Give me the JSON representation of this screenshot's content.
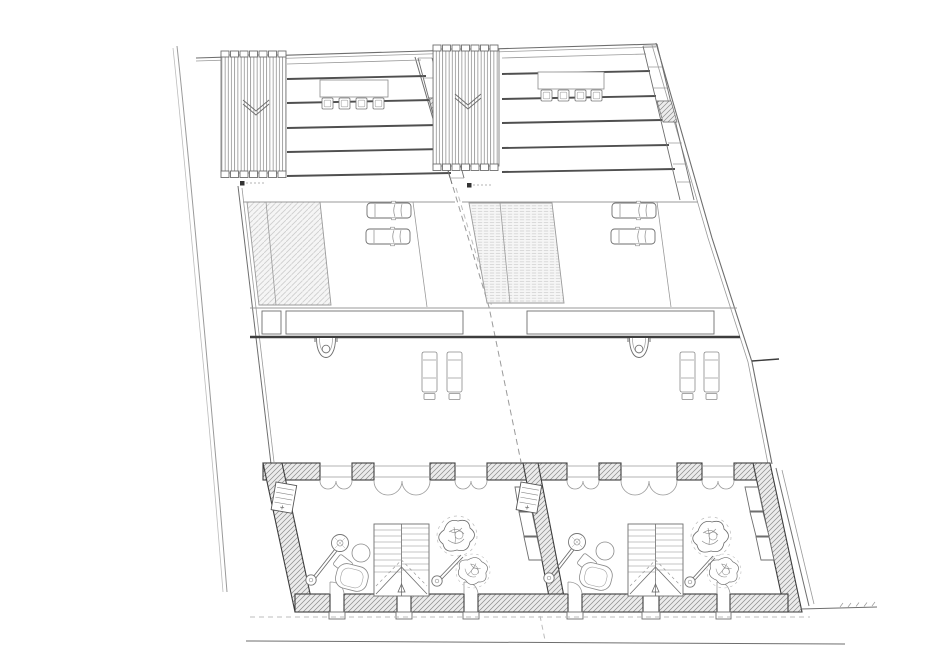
{
  "description": "architectural site and floor plan of two mirrored attached dwelling units",
  "canvas": {
    "width": 947,
    "height": 658,
    "background": "#ffffff"
  },
  "palette": {
    "paper": "#ffffff",
    "line-dark": "#3d3d3d",
    "line-mid": "#6e6e6e",
    "line-light": "#9a9a9a",
    "line-faint": "#bcbcbc",
    "wall-hatch": "#8e8e8e",
    "wall-fill": "#ececec",
    "pad-fill": "#f5f5f5",
    "pad-hatch": "#cdcdcd"
  },
  "site": {
    "boundaries": [
      "left-site-boundary",
      "top-site-boundary",
      "right-site-boundary",
      "street-edge"
    ],
    "level_markers": 2,
    "lot_divider": "dashed-center-line"
  },
  "units": [
    {
      "id": "unit-1",
      "roof": {
        "pergola_slats": 21,
        "deck_boards": 5,
        "table": 1,
        "stools": 4,
        "edge_strip_cells": 6,
        "hatched_cells": 1
      },
      "yard": {
        "planted_pad": 1,
        "cars": 2,
        "canopy_band_panels": 2,
        "outdoor_basin": 1,
        "sun_loungers": 2
      },
      "floor": {
        "staircase_flights": 2,
        "floor_lamps": 2,
        "ottoman": 1,
        "side_table": 1,
        "armchair": 1,
        "potted_plants": 2,
        "wall_niche": 1,
        "counter_cells": 3,
        "front_door_openings": 3,
        "rear_door_openings": 3
      }
    },
    {
      "id": "unit-2",
      "roof": {
        "pergola_slats": 21,
        "deck_boards": 5,
        "table": 1,
        "stools": 4,
        "edge_strip_cells": 6,
        "hatched_cells": 1
      },
      "yard": {
        "planted_pad": 1,
        "cars": 2,
        "canopy_band_panels": 1,
        "outdoor_basin": 1,
        "sun_loungers": 2
      },
      "floor": {
        "staircase_flights": 2,
        "floor_lamps": 2,
        "ottoman": 1,
        "side_table": 1,
        "armchair": 1,
        "potted_plants": 2,
        "wall_niche": 1,
        "counter_cells": 3,
        "front_door_openings": 3,
        "rear_door_openings": 3
      }
    }
  ]
}
